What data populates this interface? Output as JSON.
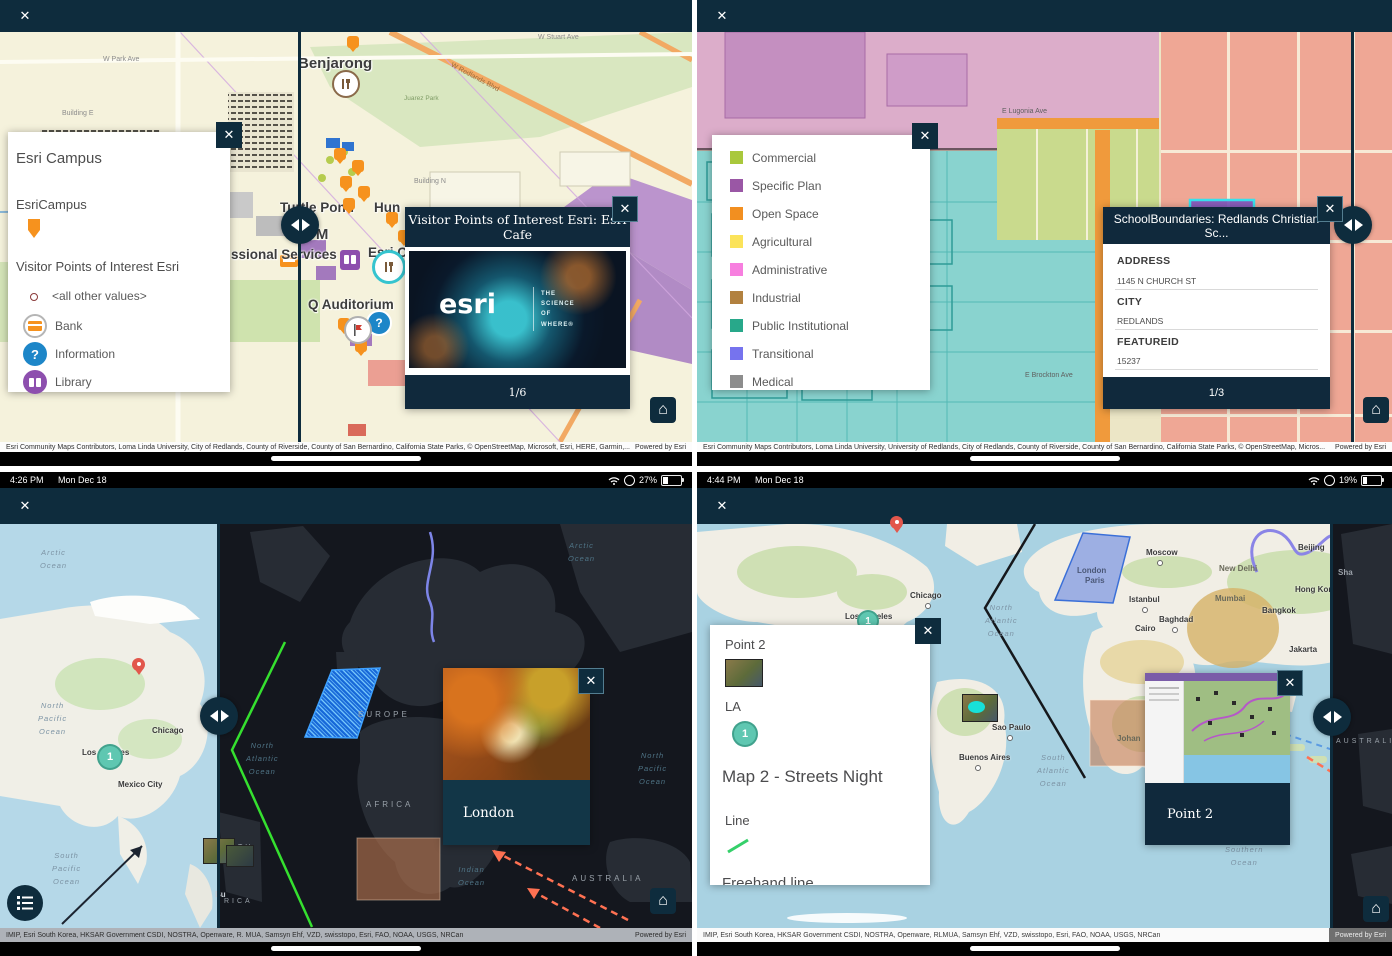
{
  "tl": {
    "navbar_close": "✕",
    "legend": {
      "title": "Esri Campus",
      "layer": "EsriCampus",
      "sublayer": "Visitor Points of Interest Esri",
      "item_other": "<all other values>",
      "item_bank": "Bank",
      "item_info": "Information",
      "item_library": "Library"
    },
    "popup": {
      "title": "Visitor Points of Interest Esri: Esri Cafe",
      "pager": "1/6",
      "logo": "esri",
      "tagline": "THE\nSCIENCE\nOF\nWHERE®"
    },
    "labels": {
      "benjarong": "Benjarong",
      "turtle_pond": "Turtle Pond",
      "hun": "Hun",
      "atm": "ATM",
      "services": "ssional Services",
      "esri_c": "Esri C",
      "auditorium": "Q Auditorium",
      "w_park": "W Park Ave",
      "w_stuart": "W Stuart Ave",
      "building_e": "Building E",
      "building_n": "Building N",
      "park": "Juarez Park",
      "redlands_blvd": "W Redlands Blvd"
    },
    "attribution": "Esri Community Maps Contributors, Loma Linda University, City of Redlands, County of Riverside, County of San Bernardino, California State Parks, © OpenStreetMap, Microsoft, Esri, HERE, Garmin,...",
    "powered": "Powered by Esri"
  },
  "tr": {
    "navbar_close": "✕",
    "legend": {
      "items": [
        {
          "label": "Commercial",
          "color": "#a9c83c"
        },
        {
          "label": "Specific Plan",
          "color": "#9a57a5"
        },
        {
          "label": "Open Space",
          "color": "#f28f20"
        },
        {
          "label": "Agricultural",
          "color": "#fbe35a"
        },
        {
          "label": "Administrative",
          "color": "#f77fdf"
        },
        {
          "label": "Industrial",
          "color": "#b2813f"
        },
        {
          "label": "Public Institutional",
          "color": "#28a88a"
        },
        {
          "label": "Transitional",
          "color": "#7673ee"
        },
        {
          "label": "Medical",
          "color": "#8d8d8d"
        }
      ]
    },
    "popup": {
      "title": "SchoolBoundaries: Redlands Christian Sc...",
      "fields": [
        {
          "label": "ADDRESS",
          "value": "1145 N CHURCH ST"
        },
        {
          "label": "CITY",
          "value": "REDLANDS"
        },
        {
          "label": "FEATUREID",
          "value": "15237"
        }
      ],
      "pager": "1/3"
    },
    "labels": {
      "lugonia": "E Lugonia Ave",
      "brockton": "E Brockton Ave",
      "campus": "Campus Ave"
    },
    "attribution": "Esri Community Maps Contributors, Loma Linda University, University of Redlands, City of Redlands, County of Riverside, County of San Bernardino, California State Parks, © OpenStreetMap, Micros...",
    "powered": "Powered by Esri"
  },
  "bl": {
    "status": {
      "time": "4:26 PM",
      "date": "Mon Dec 18",
      "battery": "27%"
    },
    "navbar_close": "✕",
    "popup_title": "London",
    "labels": {
      "arctic_l": "Arctic\nOcean",
      "n_pacific_l": "North\nPacific\nOcean",
      "s_pacific_l": "South\nPacific\nOcean",
      "chicago": "Chicago",
      "la": "Los Angeles",
      "mexico": "Mexico City",
      "marker1": "1",
      "europe": "EUROPE",
      "africa": "AFRICA",
      "australia": "AUSTRALIA",
      "arctic_d": "Arctic\nOcean",
      "n_atlantic": "North\nAtlantic\nOcean",
      "indian": "Indian\nOcean",
      "n_pacific_d": "North\nPacific\nOcean",
      "frag_th": "TH",
      "frag_rica": "RICA",
      "frag_bu": "Bu"
    },
    "attribution": "IMIP, Esri South Korea, HKSAR Government CSDI, NOSTRA, Openware, R. MUA, Samsyn Ehf, VZD, swisstopo, Esri, FAO, NOAA, USGS, NRCan",
    "powered": "Powered by Esri"
  },
  "br": {
    "status": {
      "time": "4:44 PM",
      "date": "Mon Dec 18",
      "battery": "19%"
    },
    "navbar_close": "✕",
    "panel": {
      "entry_point2": "Point 2",
      "entry_la": "LA",
      "marker1": "1",
      "map_title": "Map 2 - Streets Night",
      "entry_line": "Line",
      "entry_freehand": "Freehand line"
    },
    "popup_title": "Point 2",
    "cities": {
      "chicago": "Chicago",
      "la": "Los Angeles",
      "marker1": "1",
      "moscow": "Moscow",
      "london": "London",
      "paris": "Paris",
      "istanbul": "Istanbul",
      "baghdad": "Baghdad",
      "cairo": "Cairo",
      "new_delhi": "New Delhi",
      "mumbai": "Mumbai",
      "bangkok": "Bangkok",
      "hong_kong": "Hong Kong",
      "beijing": "Beijing",
      "shanghai": "Sha",
      "jakarta": "Jakarta",
      "sao_paulo": "Sao Paulo",
      "buenos_aires": "Buenos Aires",
      "johannesburg": "Johan"
    },
    "oceans": {
      "n_atlantic": "North\nAtlantic\nOcean",
      "s_atlantic": "South\nAtlantic\nOcean",
      "southern": "Southern\nOcean",
      "australia": "AUSTRALIA"
    },
    "attribution": "IMIP, Esri South Korea, HKSAR Government CSDI, NOSTRA, Openware, RLMUA, Samsyn Ehf, VZD, swisstopo, Esri, FAO, NOAA, USGS, NRCan",
    "powered": "Powered by Esri"
  }
}
